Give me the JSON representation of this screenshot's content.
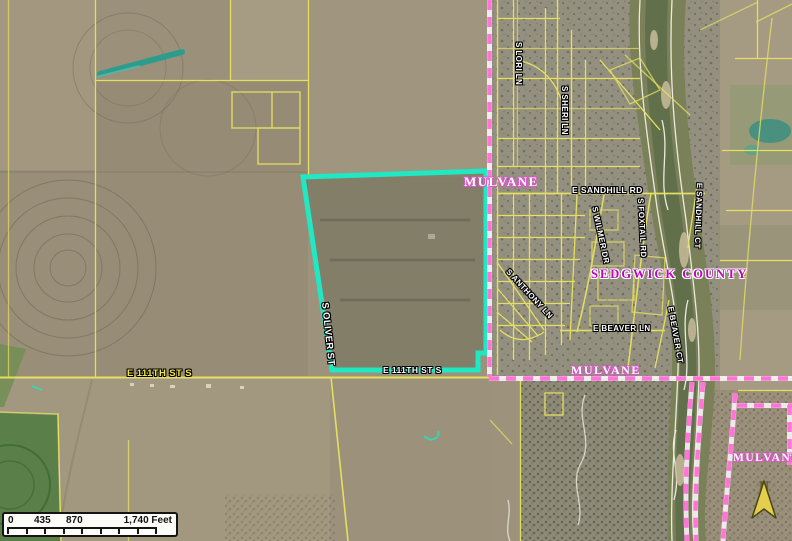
{
  "map": {
    "city_labels": {
      "nw": "MULVANE",
      "mid": "MULVANE",
      "se": "MULVANE"
    },
    "county_label": "SEDGWICK COUNTY",
    "roads": {
      "e_111th_w": "E 111TH ST S",
      "e_111th_e": "E 111TH ST S",
      "s_oliver": "S OLIVER ST",
      "e_sandhill_rd": "E SANDHILL RD",
      "e_sandhill_ct": "E SANDHILL CT",
      "s_lori_ln": "S LORI LN",
      "s_sheri_ln": "S SHERI LN",
      "s_wilmer_dr": "S WILMER DR",
      "s_foxtail_rd": "S FOXTAIL RD",
      "e_beaver_ln": "E BEAVER LN",
      "e_beaver_ct": "E BEAVER CT",
      "s_anthony_ln": "S ANTHONY LN"
    },
    "scale_bar": {
      "tick_0": "0",
      "tick_1": "435",
      "tick_2": "870",
      "tick_3": "1,740 Feet"
    },
    "north_arrow_label": "N",
    "colors": {
      "selected_parcel": "#1fe8c2",
      "city_boundary": "#ff74d6",
      "parcel_line": "#e9e45f",
      "county_label_color": "#c300c3",
      "city_label_halo": "#d957c8"
    }
  }
}
